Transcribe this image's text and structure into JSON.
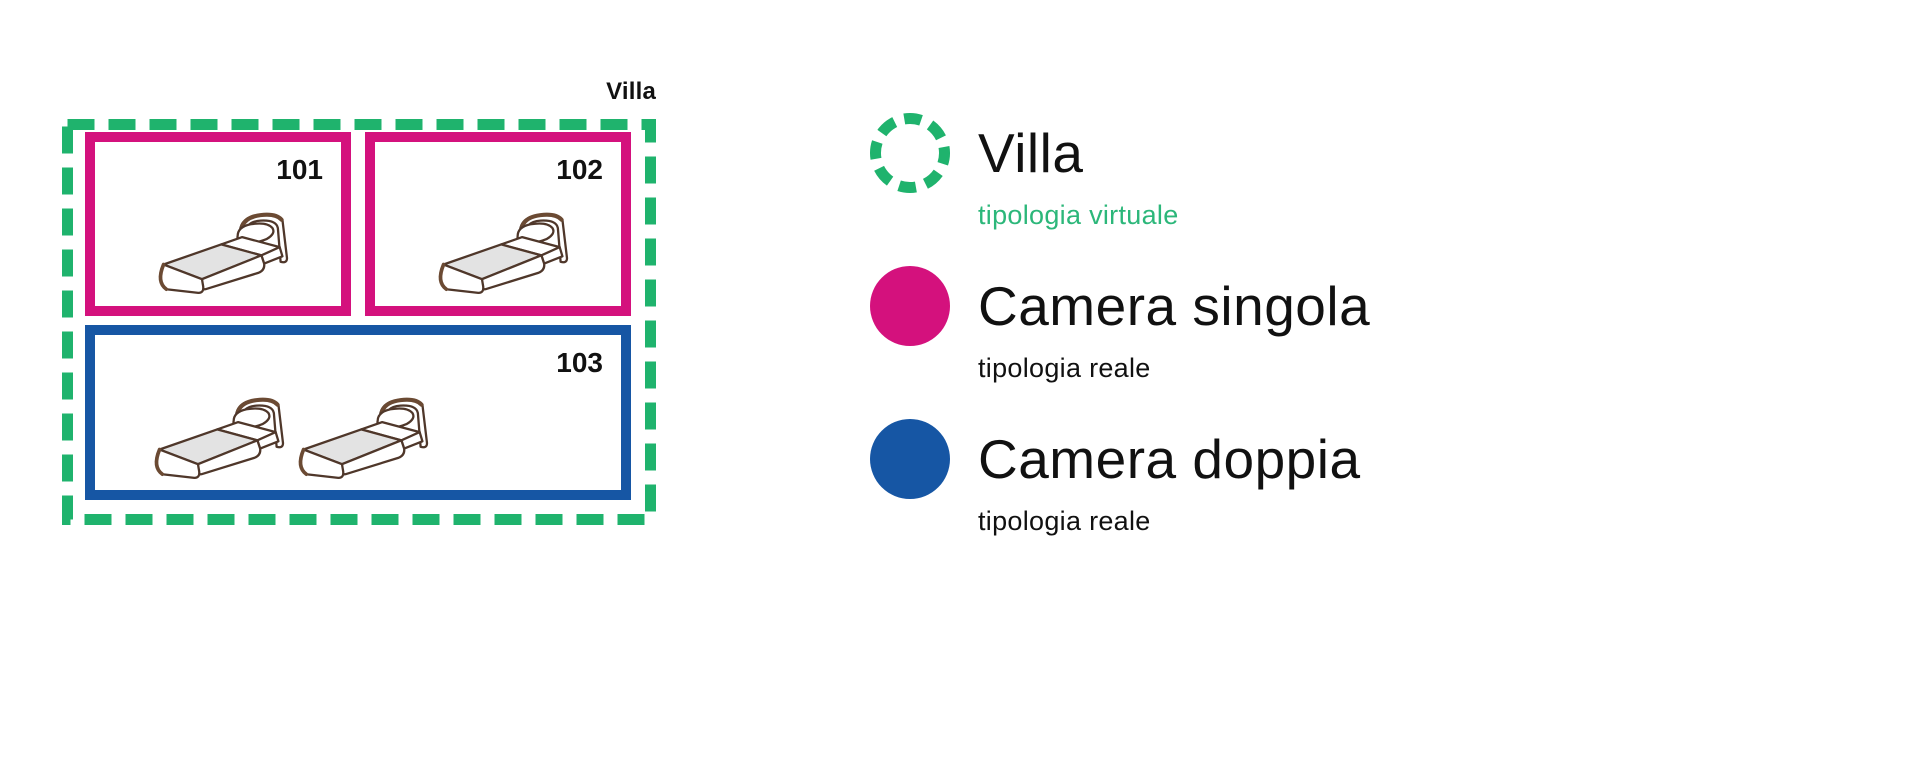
{
  "colors": {
    "green": "#1FB36D",
    "green_text": "#2CB77A",
    "pink": "#D4117D",
    "blue": "#1656A4",
    "bed_outline": "#4F372A",
    "bed_trim": "#6B4A33",
    "bed_blanket": "#E3E3E3"
  },
  "diagram": {
    "container_label": "Villa",
    "rooms": [
      {
        "number": "101",
        "type": "Camera singola",
        "beds": 1
      },
      {
        "number": "102",
        "type": "Camera singola",
        "beds": 1
      },
      {
        "number": "103",
        "type": "Camera doppia",
        "beds": 2
      }
    ]
  },
  "legend": {
    "items": [
      {
        "label": "Villa",
        "sublabel": "tipologia virtuale",
        "marker": "dashed-circle",
        "color": "#1FB36D"
      },
      {
        "label": "Camera singola",
        "sublabel": "tipologia reale",
        "marker": "solid-circle",
        "color": "#D4117D"
      },
      {
        "label": "Camera doppia",
        "sublabel": "tipologia reale",
        "marker": "solid-circle",
        "color": "#1656A4"
      }
    ]
  }
}
